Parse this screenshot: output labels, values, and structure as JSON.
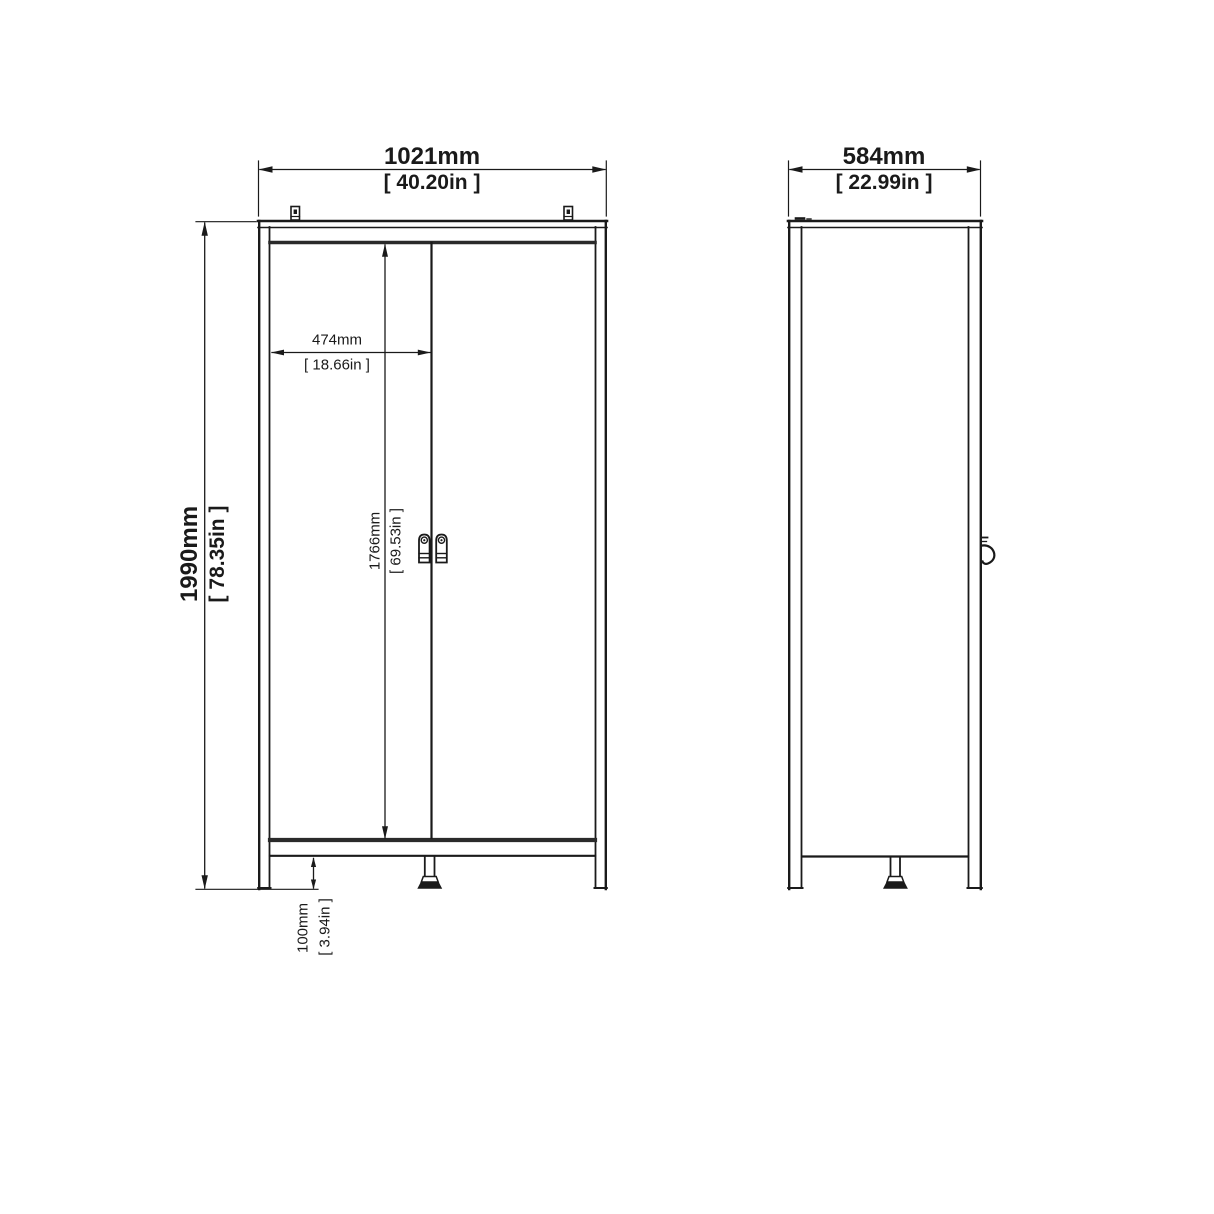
{
  "drawing": {
    "title": "Two-door wardrobe dimension drawing, front and side views",
    "front_view": {
      "width_mm": "1021mm",
      "width_in": "[ 40.20in ]",
      "height_mm": "1990mm",
      "height_in": "[ 78.35in ]",
      "door_width_mm": "474mm",
      "door_width_in": "[ 18.66in ]",
      "door_height_mm": "1766mm",
      "door_height_in": "[ 69.53in ]",
      "leg_height_mm": "100mm",
      "leg_height_in": "[ 3.94in ]"
    },
    "side_view": {
      "depth_mm": "584mm",
      "depth_in": "[ 22.99in ]"
    },
    "colors": {
      "line": "#1a1a1a",
      "background": "#ffffff"
    }
  }
}
